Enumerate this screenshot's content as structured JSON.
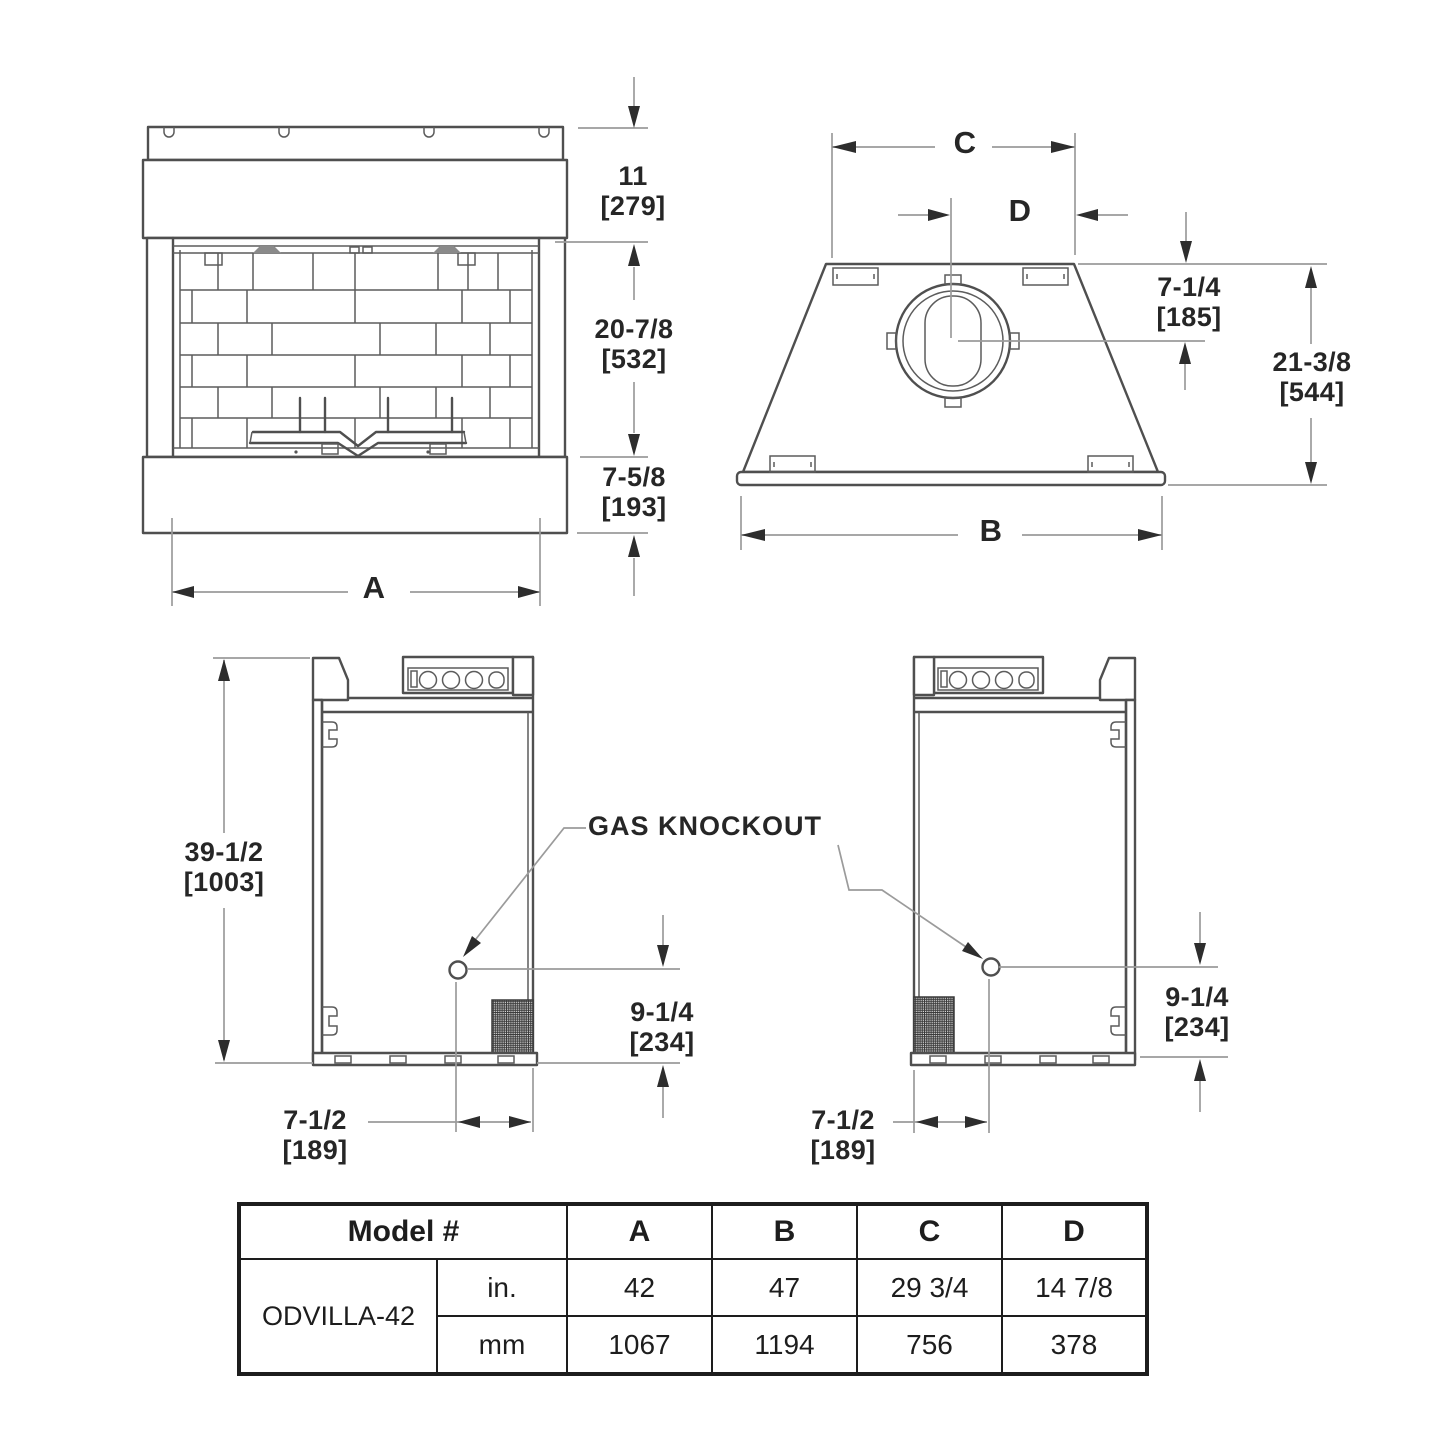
{
  "drawing": {
    "front_view": {
      "top_height_in": "11",
      "top_height_mm": "[279]",
      "opening_height_in": "20-7/8",
      "opening_height_mm": "[532]",
      "base_height_in": "7-5/8",
      "base_height_mm": "[193]",
      "width_label": "A"
    },
    "top_view": {
      "width_label_c": "C",
      "offset_label_d": "D",
      "flue_center_in": "7-1/4",
      "flue_center_mm": "[185]",
      "depth_in": "21-3/8",
      "depth_mm": "[544]",
      "width_label_b": "B"
    },
    "left_side_view": {
      "height_in": "39-1/2",
      "height_mm": "[1003]",
      "knockout_height_in": "9-1/4",
      "knockout_height_mm": "[234]",
      "knockout_depth_in": "7-1/2",
      "knockout_depth_mm": "[189]"
    },
    "right_side_view": {
      "knockout_height_in": "9-1/4",
      "knockout_height_mm": "[234]",
      "knockout_depth_in": "7-1/2",
      "knockout_depth_mm": "[189]"
    },
    "callout": "GAS KNOCKOUT"
  },
  "table": {
    "model_header": "Model #",
    "col_a": "A",
    "col_b": "B",
    "col_c": "C",
    "col_d": "D",
    "model_name": "ODVILLA-42",
    "rows": [
      {
        "unit": "in.",
        "a": "42",
        "b": "47",
        "c": "29 3/4",
        "d": "14 7/8"
      },
      {
        "unit": "mm",
        "a": "1067",
        "b": "1194",
        "c": "756",
        "d": "378"
      }
    ]
  }
}
